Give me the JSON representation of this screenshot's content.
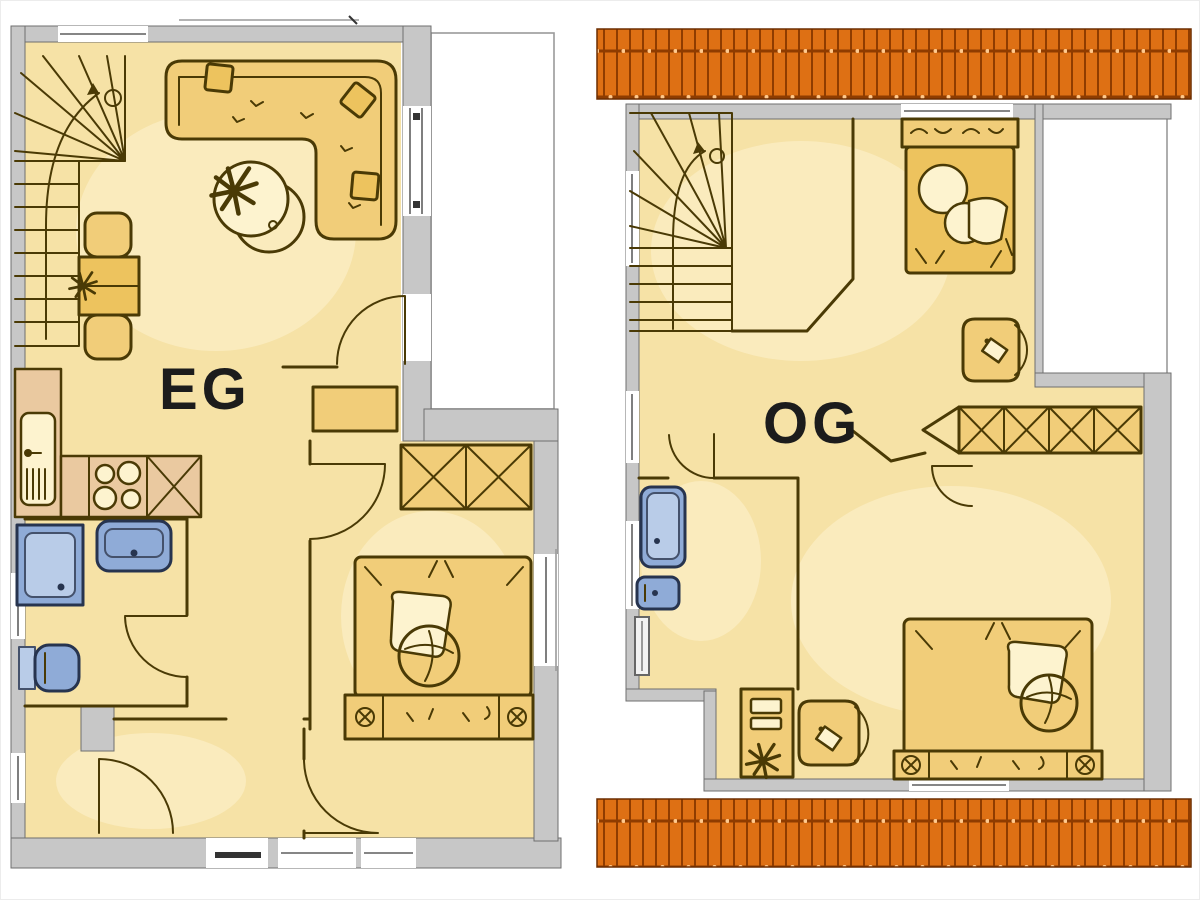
{
  "plans": {
    "eg": {
      "label": "EG",
      "furniture": [
        "staircase",
        "l-shaped-sofa",
        "coffee-table-with-plant",
        "dining-table-with-two-chairs",
        "kitchen-counter-with-sink",
        "stove",
        "x-cabinet",
        "shower",
        "washbasin",
        "toilet",
        "wardrobe",
        "double-bed",
        "sideboard",
        "terrace"
      ]
    },
    "og": {
      "label": "OG",
      "furniture": [
        "staircase",
        "single-bed",
        "armchair",
        "wardrobe",
        "bathtub",
        "washbasin",
        "radiator",
        "desk-with-chair",
        "plant",
        "double-bed",
        "roof-surface-top",
        "roof-surface-bottom"
      ]
    }
  },
  "colors": {
    "background": "#ffffff",
    "floor": "#f6e2a6",
    "floor_bright": "#fdf3cf",
    "furniture": "#f1cd79",
    "furniture_deep": "#edc35e",
    "counter": "#eac9a0",
    "line": "#4a3a05",
    "wall": "#c7c7c7",
    "wall_stroke": "#6f6f6f",
    "fixture": "#8fabd7",
    "fixture_light": "#b9cce8",
    "fixture_stroke": "#27344f",
    "roof": "#de7014",
    "roof_line": "#8f3c00",
    "roof_dot": "#ffc98d",
    "label_text": "#1c1c1c"
  }
}
